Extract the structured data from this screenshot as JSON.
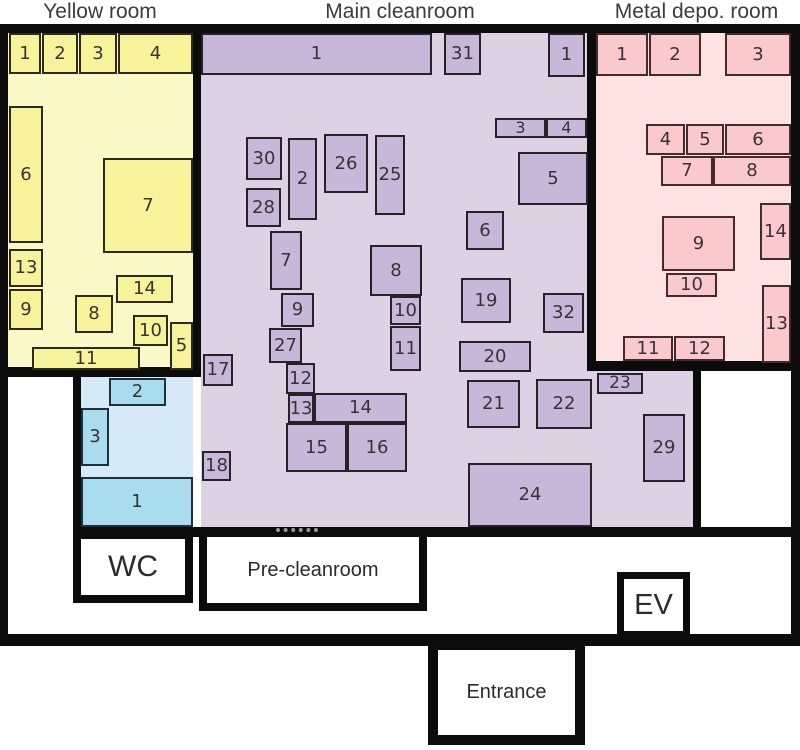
{
  "colors": {
    "wall": "#0b0b0b",
    "background": "#ffffff",
    "number_text": "#3a3136",
    "title_text": "#3c3c3c"
  },
  "titles": [
    {
      "text": "Yellow room",
      "x": 10,
      "y": 0,
      "w": 180,
      "h": 24
    },
    {
      "text": "Main cleanroom",
      "x": 295,
      "y": 0,
      "w": 210,
      "h": 24
    },
    {
      "text": "Metal depo. room",
      "x": 593,
      "y": 0,
      "w": 207,
      "h": 24
    }
  ],
  "walls": [
    {
      "name": "outer-top",
      "x": 0,
      "y": 24,
      "w": 800,
      "h": 9
    },
    {
      "name": "outer-left",
      "x": 0,
      "y": 24,
      "w": 8,
      "h": 622
    },
    {
      "name": "outer-right",
      "x": 791,
      "y": 24,
      "w": 9,
      "h": 622
    },
    {
      "name": "outer-bottom",
      "x": 0,
      "y": 634,
      "w": 800,
      "h": 12
    },
    {
      "name": "yellow-main",
      "x": 193,
      "y": 24,
      "w": 8,
      "h": 353
    },
    {
      "name": "yellow-bottom",
      "x": 0,
      "y": 367,
      "w": 201,
      "h": 10
    },
    {
      "name": "main-metal",
      "x": 587,
      "y": 24,
      "w": 9,
      "h": 347
    },
    {
      "name": "metal-bottom",
      "x": 587,
      "y": 361,
      "w": 213,
      "h": 10
    },
    {
      "name": "annex-sideroom",
      "x": 693,
      "y": 361,
      "w": 8,
      "h": 175
    },
    {
      "name": "cleanroom-bottom",
      "x": 73,
      "y": 527,
      "w": 718,
      "h": 10
    },
    {
      "name": "blue-left",
      "x": 73,
      "y": 367,
      "w": 8,
      "h": 170
    }
  ],
  "door_dashes": [
    {
      "name": "precleanroom-door",
      "x": 276,
      "y": 528,
      "w": 42
    }
  ],
  "rooms": [
    {
      "name": "yellow-room",
      "short": "yellow",
      "x": 8,
      "y": 33,
      "w": 185,
      "h": 334,
      "bg": "#fbf9c8",
      "item_bg": "#f6f39a",
      "item_border": "#2e2a22",
      "items": [
        {
          "label": "1",
          "x": 9,
          "y": 33,
          "w": 32,
          "h": 41
        },
        {
          "label": "2",
          "x": 42,
          "y": 33,
          "w": 36,
          "h": 41
        },
        {
          "label": "3",
          "x": 79,
          "y": 33,
          "w": 38,
          "h": 41
        },
        {
          "label": "4",
          "x": 118,
          "y": 33,
          "w": 75,
          "h": 41
        },
        {
          "label": "6",
          "x": 9,
          "y": 106,
          "w": 34,
          "h": 137
        },
        {
          "label": "7",
          "x": 103,
          "y": 158,
          "w": 90,
          "h": 95
        },
        {
          "label": "13",
          "x": 9,
          "y": 249,
          "w": 34,
          "h": 38
        },
        {
          "label": "9",
          "x": 9,
          "y": 289,
          "w": 34,
          "h": 41
        },
        {
          "label": "14",
          "x": 116,
          "y": 275,
          "w": 57,
          "h": 28
        },
        {
          "label": "8",
          "x": 75,
          "y": 295,
          "w": 38,
          "h": 38
        },
        {
          "label": "10",
          "x": 133,
          "y": 315,
          "w": 35,
          "h": 31
        },
        {
          "label": "5",
          "x": 170,
          "y": 322,
          "w": 23,
          "h": 48
        },
        {
          "label": "11",
          "x": 32,
          "y": 347,
          "w": 108,
          "h": 23
        }
      ]
    },
    {
      "name": "main-cleanroom",
      "short": "main",
      "x": 201,
      "y": 33,
      "w": 386,
      "h": 494,
      "bg": "#dcd2e4",
      "item_bg": "#c9b7da",
      "item_border": "#272226",
      "items": [
        {
          "label": "1",
          "x": 201,
          "y": 33,
          "w": 231,
          "h": 42
        },
        {
          "label": "31",
          "x": 444,
          "y": 33,
          "w": 37,
          "h": 42
        },
        {
          "label": "1",
          "x": 548,
          "y": 33,
          "w": 37,
          "h": 44
        },
        {
          "label": "3",
          "x": 495,
          "y": 118,
          "w": 51,
          "h": 20
        },
        {
          "label": "4",
          "x": 546,
          "y": 118,
          "w": 41,
          "h": 20
        },
        {
          "label": "5",
          "x": 518,
          "y": 152,
          "w": 70,
          "h": 53
        },
        {
          "label": "6",
          "x": 466,
          "y": 211,
          "w": 38,
          "h": 39
        },
        {
          "label": "30",
          "x": 246,
          "y": 137,
          "w": 36,
          "h": 43
        },
        {
          "label": "2",
          "x": 288,
          "y": 138,
          "w": 29,
          "h": 82
        },
        {
          "label": "26",
          "x": 324,
          "y": 134,
          "w": 44,
          "h": 59
        },
        {
          "label": "25",
          "x": 375,
          "y": 135,
          "w": 30,
          "h": 80
        },
        {
          "label": "28",
          "x": 246,
          "y": 188,
          "w": 35,
          "h": 39
        },
        {
          "label": "7",
          "x": 270,
          "y": 231,
          "w": 32,
          "h": 59
        },
        {
          "label": "8",
          "x": 370,
          "y": 245,
          "w": 52,
          "h": 51
        },
        {
          "label": "9",
          "x": 281,
          "y": 293,
          "w": 33,
          "h": 34
        },
        {
          "label": "10",
          "x": 390,
          "y": 296,
          "w": 31,
          "h": 29
        },
        {
          "label": "11",
          "x": 390,
          "y": 326,
          "w": 31,
          "h": 45
        },
        {
          "label": "19",
          "x": 461,
          "y": 278,
          "w": 50,
          "h": 45
        },
        {
          "label": "32",
          "x": 543,
          "y": 293,
          "w": 41,
          "h": 40
        },
        {
          "label": "27",
          "x": 269,
          "y": 328,
          "w": 33,
          "h": 35
        },
        {
          "label": "20",
          "x": 459,
          "y": 341,
          "w": 72,
          "h": 31
        },
        {
          "label": "17",
          "x": 203,
          "y": 354,
          "w": 30,
          "h": 32
        },
        {
          "label": "12",
          "x": 286,
          "y": 363,
          "w": 29,
          "h": 31
        },
        {
          "label": "13",
          "x": 288,
          "y": 394,
          "w": 26,
          "h": 29
        },
        {
          "label": "14",
          "x": 314,
          "y": 393,
          "w": 93,
          "h": 30
        },
        {
          "label": "21",
          "x": 467,
          "y": 380,
          "w": 53,
          "h": 48
        },
        {
          "label": "22",
          "x": 536,
          "y": 379,
          "w": 56,
          "h": 50
        },
        {
          "label": "23",
          "x": 597,
          "y": 373,
          "w": 46,
          "h": 21
        },
        {
          "label": "29",
          "x": 643,
          "y": 414,
          "w": 42,
          "h": 68
        },
        {
          "label": "15",
          "x": 286,
          "y": 423,
          "w": 61,
          "h": 49
        },
        {
          "label": "16",
          "x": 347,
          "y": 423,
          "w": 60,
          "h": 49
        },
        {
          "label": "18",
          "x": 202,
          "y": 451,
          "w": 29,
          "h": 30
        },
        {
          "label": "24",
          "x": 468,
          "y": 463,
          "w": 124,
          "h": 64
        }
      ]
    },
    {
      "name": "main-cleanroom-annex",
      "short": "annex",
      "x": 587,
      "y": 371,
      "w": 106,
      "h": 156,
      "bg": "#dcd2e4",
      "item_bg": "#c9b7da",
      "item_border": "#272226",
      "items": []
    },
    {
      "name": "metal-depo-room",
      "short": "metal",
      "x": 596,
      "y": 33,
      "w": 195,
      "h": 328,
      "bg": "#fce2e1",
      "item_bg": "#f9c9cc",
      "item_border": "#46292c",
      "items": [
        {
          "label": "1",
          "x": 596,
          "y": 33,
          "w": 52,
          "h": 43
        },
        {
          "label": "2",
          "x": 649,
          "y": 33,
          "w": 52,
          "h": 43
        },
        {
          "label": "3",
          "x": 725,
          "y": 33,
          "w": 66,
          "h": 43
        },
        {
          "label": "4",
          "x": 646,
          "y": 124,
          "w": 39,
          "h": 31
        },
        {
          "label": "5",
          "x": 686,
          "y": 124,
          "w": 38,
          "h": 31
        },
        {
          "label": "6",
          "x": 725,
          "y": 124,
          "w": 66,
          "h": 31
        },
        {
          "label": "7",
          "x": 661,
          "y": 156,
          "w": 52,
          "h": 30
        },
        {
          "label": "8",
          "x": 713,
          "y": 156,
          "w": 78,
          "h": 30
        },
        {
          "label": "14",
          "x": 760,
          "y": 203,
          "w": 31,
          "h": 57
        },
        {
          "label": "9",
          "x": 662,
          "y": 216,
          "w": 73,
          "h": 55
        },
        {
          "label": "10",
          "x": 666,
          "y": 273,
          "w": 51,
          "h": 24
        },
        {
          "label": "13",
          "x": 762,
          "y": 285,
          "w": 29,
          "h": 78
        },
        {
          "label": "11",
          "x": 623,
          "y": 336,
          "w": 50,
          "h": 25
        },
        {
          "label": "12",
          "x": 674,
          "y": 336,
          "w": 51,
          "h": 25
        }
      ]
    },
    {
      "name": "blue-room",
      "short": "blue",
      "x": 81,
      "y": 377,
      "w": 112,
      "h": 150,
      "bg": "#d6eaf5",
      "item_bg": "#a8dcee",
      "item_border": "#20303b",
      "items": [
        {
          "label": "2",
          "x": 109,
          "y": 378,
          "w": 57,
          "h": 28
        },
        {
          "label": "3",
          "x": 81,
          "y": 408,
          "w": 28,
          "h": 58
        },
        {
          "label": "1",
          "x": 81,
          "y": 477,
          "w": 112,
          "h": 50
        }
      ]
    },
    {
      "name": "side-room-right",
      "short": "side",
      "x": 701,
      "y": 371,
      "w": 90,
      "h": 156,
      "bg": "#ffffff",
      "item_bg": "#ffffff",
      "item_border": "#272226",
      "items": []
    }
  ],
  "labeled_rooms": [
    {
      "name": "wc",
      "label": "WC",
      "x": 73,
      "y": 531,
      "w": 120,
      "h": 72,
      "border": 8,
      "font": 30
    },
    {
      "name": "pre-cleanroom",
      "label": "Pre-cleanroom",
      "x": 199,
      "y": 529,
      "w": 228,
      "h": 82,
      "border": 8,
      "font": 20
    },
    {
      "name": "ev",
      "label": "EV",
      "x": 617,
      "y": 572,
      "w": 73,
      "h": 66,
      "border": 7,
      "font": 29
    },
    {
      "name": "entrance",
      "label": "Entrance",
      "x": 428,
      "y": 640,
      "w": 157,
      "h": 105,
      "border": 10,
      "font": 20
    }
  ]
}
